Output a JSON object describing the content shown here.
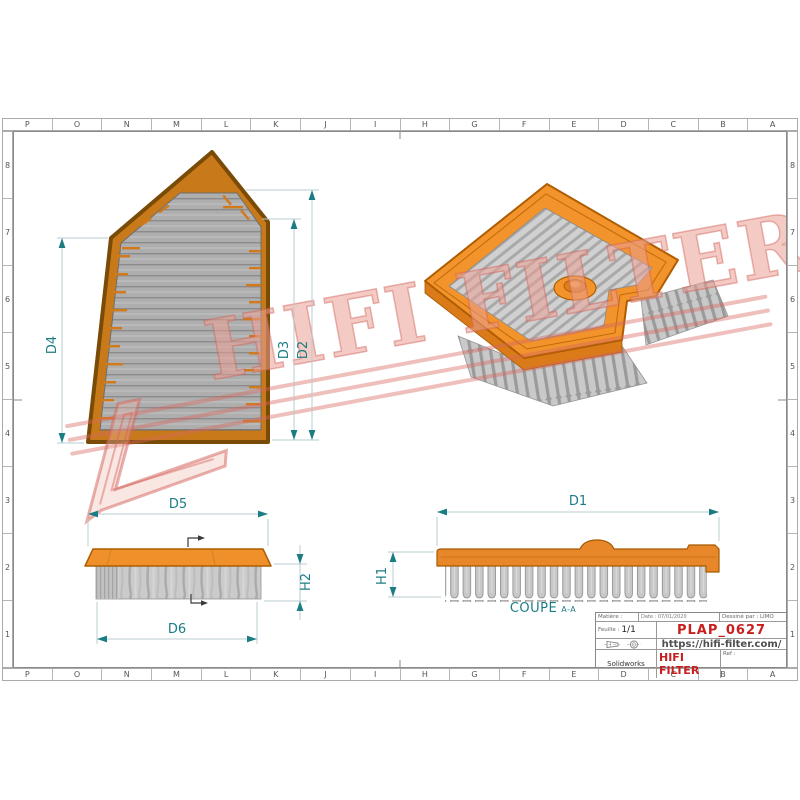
{
  "grid": {
    "columns": [
      "P",
      "O",
      "N",
      "M",
      "L",
      "K",
      "J",
      "I",
      "H",
      "G",
      "F",
      "E",
      "D",
      "C",
      "B",
      "A"
    ],
    "rows": [
      "8",
      "7",
      "6",
      "5",
      "4",
      "3",
      "2",
      "1"
    ]
  },
  "dims": {
    "d1": "D1",
    "d2": "D2",
    "d3": "D3",
    "d4": "D4",
    "d5": "D5",
    "d6": "D6",
    "h1": "H1",
    "h2": "H2"
  },
  "section_label": {
    "main": "COUPE",
    "detail": "A-A"
  },
  "watermark": {
    "brand": "HIFI FILTER",
    "registered": "®"
  },
  "title_block": {
    "matiere_label": "Matière :",
    "date_label": "Date : 07/01/2020",
    "dessine_label": "Dessiné par : LIMO",
    "feuille_label": "Feuille :",
    "feuille_value": "1/1",
    "part_number": "PLAP_0627",
    "website": "https://hifi-filter.com/",
    "software": "Solidworks",
    "brand": "HIFI FILTER",
    "ref_label": "Ref :"
  },
  "colors": {
    "accent_orange": "#F2932C",
    "frame_orange_dark": "#C87A1A",
    "media_gray": "#AEAEAE",
    "dimension_teal": "#1C7C84",
    "brand_red": "#C81E1E",
    "watermark_pink": "#D6675C"
  }
}
